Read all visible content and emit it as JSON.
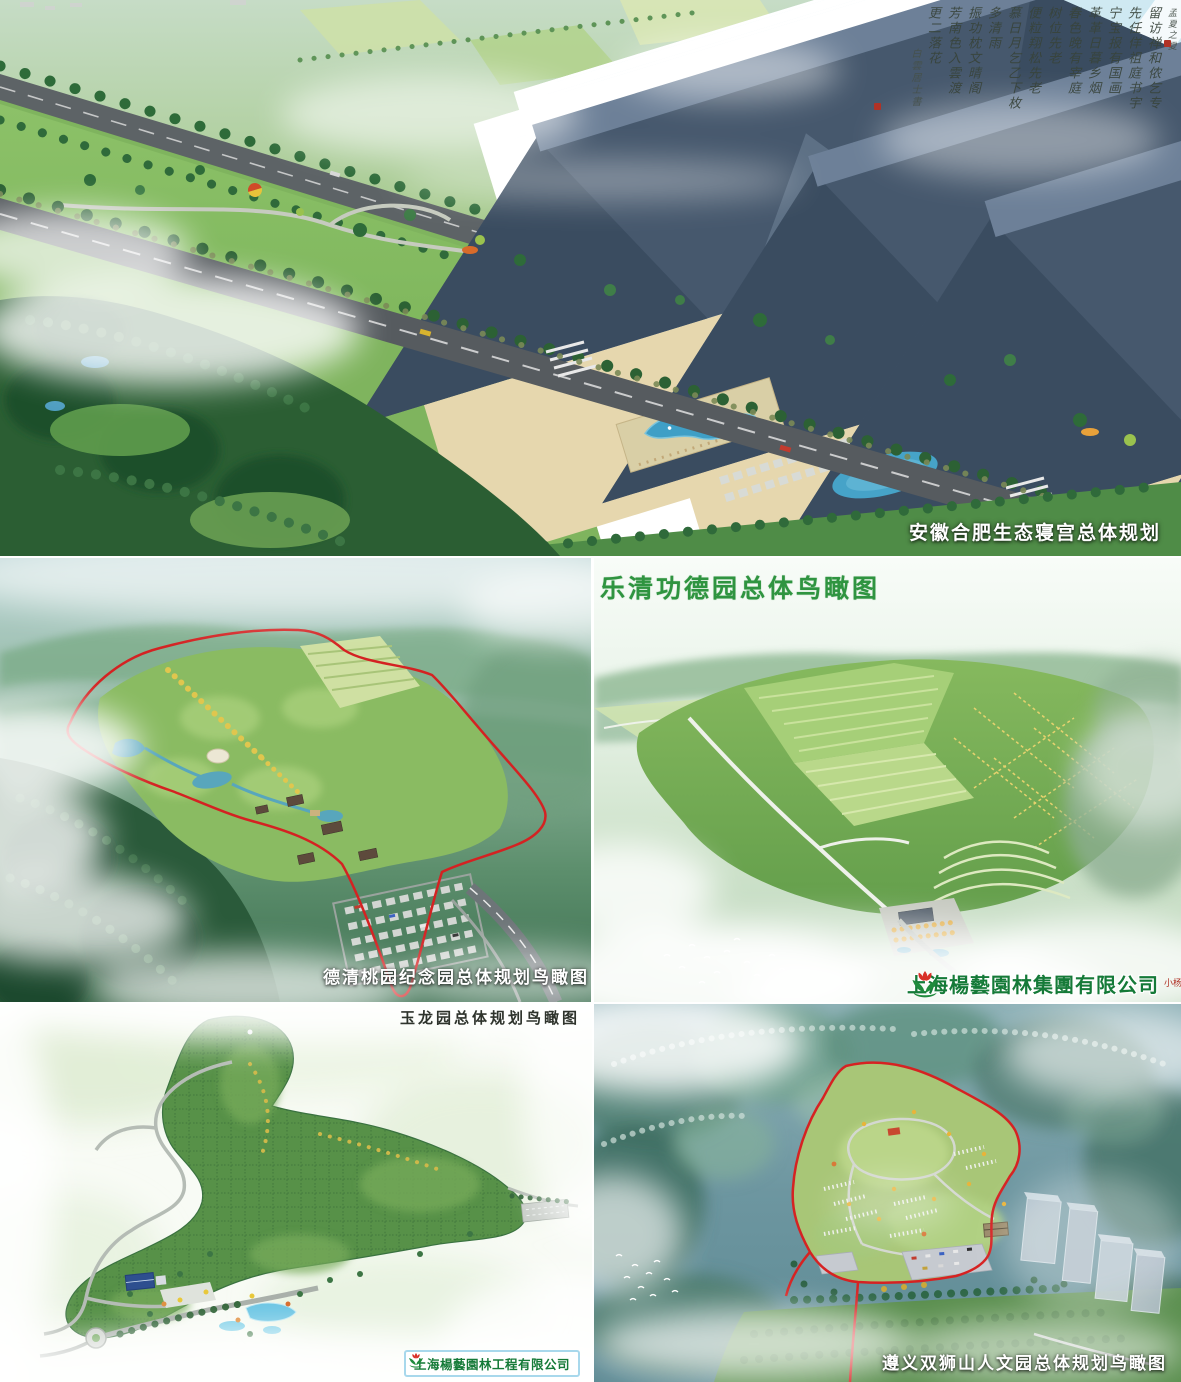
{
  "collage": {
    "hefei": {
      "caption": "安徽合肥生态寝宫总体规划",
      "calligraphy": [
        "孟夏之夏",
        "留访禅和侬乞专",
        "先任佯祖庭书宇",
        "宁宝报有国画",
        "革革日暮乡烟",
        "春色晚有宰庭",
        "树位先老",
        "便粒翔松先老",
        "慕日月乞乙下枚",
        "多清雨",
        "振功枕文晴阁",
        "芳南色入雲渡",
        "更二落花"
      ],
      "calligraphy_signature": "白雲居士書"
    },
    "deqing": {
      "caption": "德清桃园纪念园总体规划鸟瞰图"
    },
    "yueqing": {
      "title": "乐清功德园总体鸟瞰图",
      "company": "上海楊藝園林集團有限公司",
      "company_seal": "小杨"
    },
    "yulong": {
      "caption": "玉龙园总体规划鸟瞰图",
      "company": "上海楊藝園林工程有限公司"
    },
    "zunyi": {
      "caption": "遵义双狮山人文园总体规划鸟瞰图"
    }
  },
  "colors": {
    "caption_white": "#ffffff",
    "title_green": "#2f9440",
    "logo_green": "#157a38",
    "boundary_red": "#d42222",
    "caption_dark": "#2e332c"
  }
}
